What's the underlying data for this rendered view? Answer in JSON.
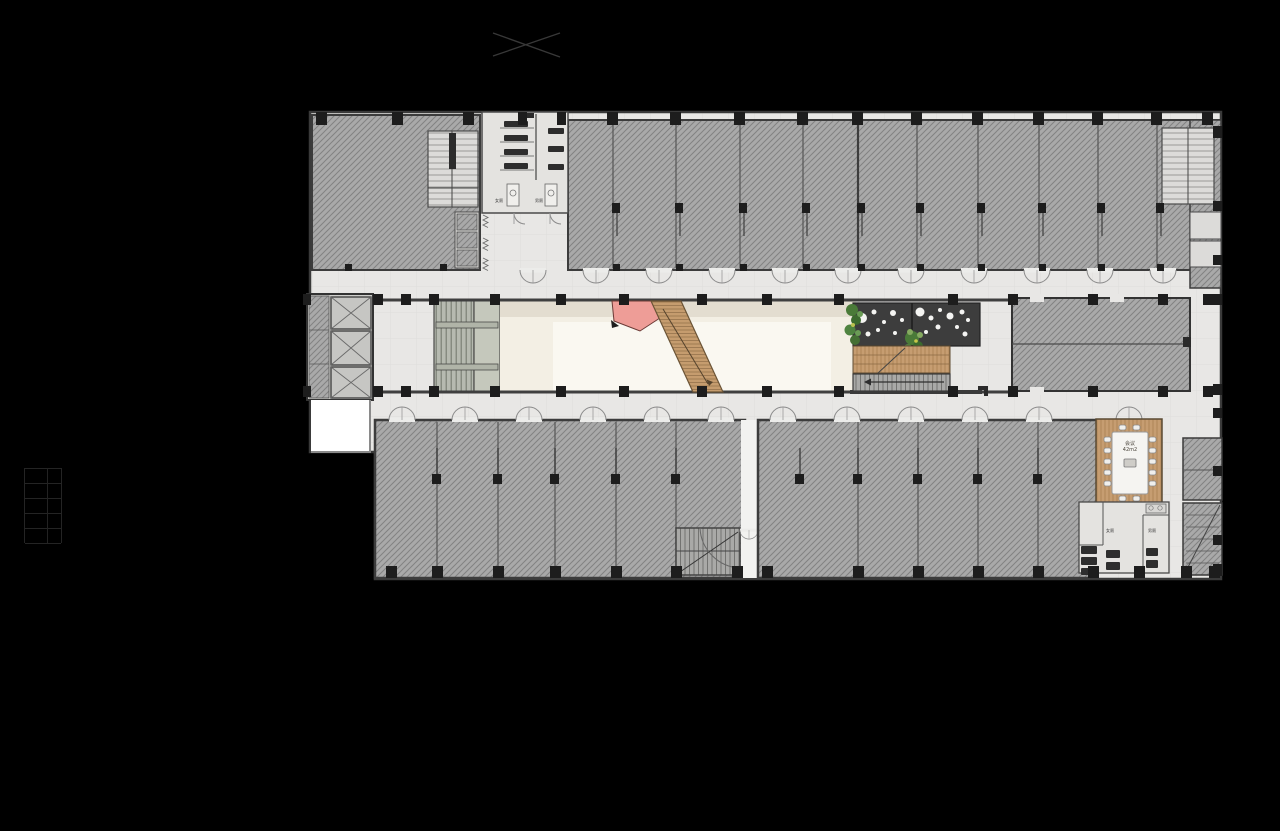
{
  "scene": {
    "type": "architectural-floor-plan",
    "background": "#000000",
    "description": "Office building floor plan with central atrium, feature stair and tenant suites"
  },
  "labels": {
    "meeting_room_name": "会议",
    "meeting_room_area": "42m2",
    "toilet_female_upper": "女厕",
    "toilet_male_upper": "男厕",
    "toilet_female_lower": "女厕",
    "toilet_male_lower": "男厕"
  },
  "colors": {
    "suite_hatch_fill": "#a9a9a9",
    "corridor_paper": "#e8e7e5",
    "atrium_floor": "#f3efe4",
    "wood": "#c49a6c",
    "feature_wall_dark": "#3d3d3d",
    "accent_pink": "#ec9c96",
    "plant_green": "#4a7a38",
    "wall_line": "#3a3a3a"
  }
}
